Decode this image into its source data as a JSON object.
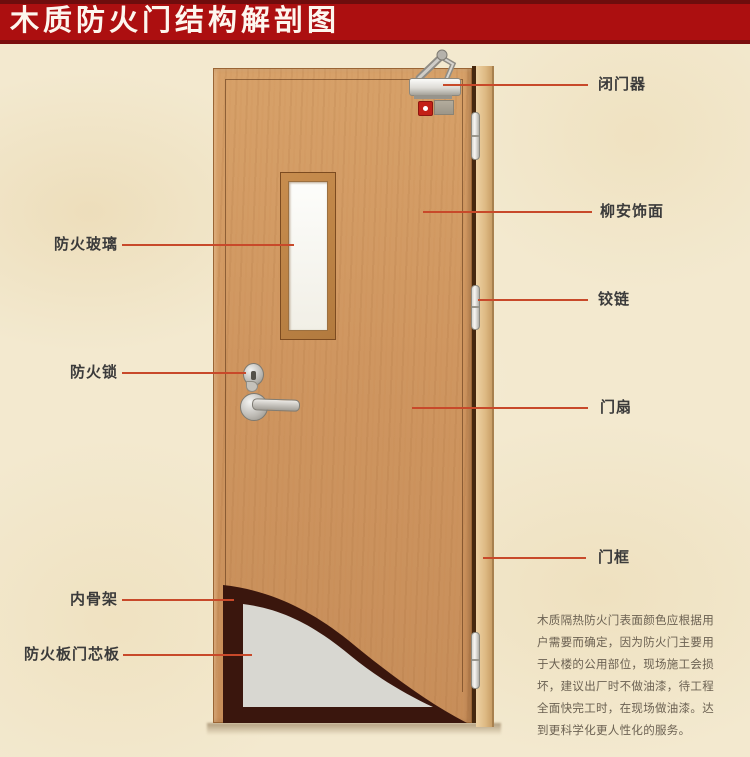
{
  "header": {
    "title": "木质防火门结构解剖图"
  },
  "labels": {
    "left": [
      {
        "text": "防火玻璃"
      },
      {
        "text": "防火锁"
      },
      {
        "text": "内骨架"
      },
      {
        "text": "防火板门芯板"
      }
    ],
    "right": [
      {
        "text": "闭门器"
      },
      {
        "text": "柳安饰面"
      },
      {
        "text": "铰链"
      },
      {
        "text": "门扇"
      },
      {
        "text": "门框"
      }
    ]
  },
  "note": {
    "text": "木质隔热防火门表面颜色应根据用户需要而确定，因为防火门主要用于大楼的公用部位，现场施工会损坏，建议出厂时不做油漆，待工程全面快完工时，在现场做油漆。达到更科学化更人性化的服务。"
  },
  "colors": {
    "banner_red": "#ac0f10",
    "banner_border": "#6e0d0d",
    "leader_line": "#c8492a",
    "label_text": "#3b3b3b",
    "door_wood": "#d19a62",
    "frame_wood": "#ddb983",
    "inner_skeleton": "#3a160d",
    "core_panel": "#d8d7d1",
    "background": "#f3e9cf"
  }
}
